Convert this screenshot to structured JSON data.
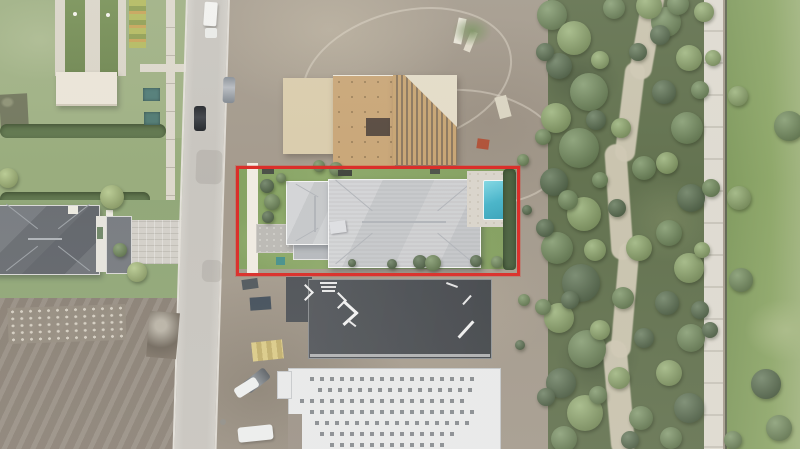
{
  "scene": {
    "description": "Aerial drone photograph of a residential street with a new-construction subject property outlined in red; existing home and lawns to the west, two homes under construction, and a wooded preserve with a sandy trail and concrete path to the east",
    "type": "aerial-photograph"
  },
  "annotation": {
    "label": "Subject property boundary",
    "box_style": "left:236px;top:166px;width:278px;height:104px;border-color:#e5231d",
    "color": "#e5231d"
  },
  "palette": {
    "red": "#e5231d",
    "lawn1": "#9cb07e",
    "lawn2": "#8da671",
    "court": "#6f8a4d",
    "walk": "#dcd7ca",
    "canopy": "#eae4d6",
    "hedge": "#5b7446",
    "road": "#c8c5be",
    "dirt": "#a39889",
    "ply": "#c9a26d",
    "roof": "#cccdd0",
    "pool": "#43c0d5",
    "deck": "#d9d4c9",
    "dkroof": "#45494e",
    "wroof": "#e9eaeb",
    "trail": "#cfc7b0",
    "path": "#d9d5ca",
    "rgrass": "#83a05c",
    "t1": "#4d6640",
    "t2": "#69884e",
    "t3": "#87a65e",
    "t4": "#a3bd6e"
  },
  "trees": [
    {
      "x": 552,
      "y": 15,
      "r": 15,
      "c": "t2"
    },
    {
      "x": 574,
      "y": 38,
      "r": 17,
      "c": "t3"
    },
    {
      "x": 559,
      "y": 66,
      "r": 13,
      "c": "t1"
    },
    {
      "x": 589,
      "y": 92,
      "r": 19,
      "c": "t2"
    },
    {
      "x": 556,
      "y": 118,
      "r": 15,
      "c": "t3"
    },
    {
      "x": 579,
      "y": 148,
      "r": 20,
      "c": "t2"
    },
    {
      "x": 554,
      "y": 182,
      "r": 14,
      "c": "t1"
    },
    {
      "x": 584,
      "y": 214,
      "r": 17,
      "c": "t3"
    },
    {
      "x": 557,
      "y": 248,
      "r": 16,
      "c": "t2"
    },
    {
      "x": 581,
      "y": 283,
      "r": 19,
      "c": "t1"
    },
    {
      "x": 559,
      "y": 318,
      "r": 15,
      "c": "t3"
    },
    {
      "x": 587,
      "y": 349,
      "r": 19,
      "c": "t2"
    },
    {
      "x": 561,
      "y": 383,
      "r": 15,
      "c": "t1"
    },
    {
      "x": 585,
      "y": 413,
      "r": 18,
      "c": "t3"
    },
    {
      "x": 564,
      "y": 439,
      "r": 13,
      "c": "t2"
    },
    {
      "x": 545,
      "y": 52,
      "r": 9,
      "c": "t1"
    },
    {
      "x": 543,
      "y": 137,
      "r": 8,
      "c": "t2"
    },
    {
      "x": 545,
      "y": 228,
      "r": 9,
      "c": "t1"
    },
    {
      "x": 543,
      "y": 307,
      "r": 8,
      "c": "t2"
    },
    {
      "x": 546,
      "y": 397,
      "r": 9,
      "c": "t1"
    },
    {
      "x": 568,
      "y": 200,
      "r": 10,
      "c": "t2"
    },
    {
      "x": 595,
      "y": 250,
      "r": 11,
      "c": "t3"
    },
    {
      "x": 570,
      "y": 300,
      "r": 9,
      "c": "t1"
    },
    {
      "x": 596,
      "y": 120,
      "r": 10,
      "c": "t1"
    },
    {
      "x": 600,
      "y": 60,
      "r": 9,
      "c": "t3"
    },
    {
      "x": 600,
      "y": 330,
      "r": 10,
      "c": "t3"
    },
    {
      "x": 598,
      "y": 395,
      "r": 9,
      "c": "t2"
    },
    {
      "x": 600,
      "y": 180,
      "r": 8,
      "c": "t2"
    },
    {
      "x": 614,
      "y": 8,
      "r": 11,
      "c": "t2"
    },
    {
      "x": 638,
      "y": 52,
      "r": 9,
      "c": "t1"
    },
    {
      "x": 621,
      "y": 128,
      "r": 10,
      "c": "t3"
    },
    {
      "x": 644,
      "y": 168,
      "r": 12,
      "c": "t2"
    },
    {
      "x": 617,
      "y": 208,
      "r": 9,
      "c": "t1"
    },
    {
      "x": 639,
      "y": 248,
      "r": 13,
      "c": "t3"
    },
    {
      "x": 623,
      "y": 298,
      "r": 11,
      "c": "t2"
    },
    {
      "x": 644,
      "y": 338,
      "r": 10,
      "c": "t1"
    },
    {
      "x": 619,
      "y": 378,
      "r": 11,
      "c": "t3"
    },
    {
      "x": 641,
      "y": 418,
      "r": 12,
      "c": "t2"
    },
    {
      "x": 630,
      "y": 440,
      "r": 9,
      "c": "t1"
    },
    {
      "x": 666,
      "y": 22,
      "r": 15,
      "c": "t2"
    },
    {
      "x": 689,
      "y": 58,
      "r": 13,
      "c": "t3"
    },
    {
      "x": 664,
      "y": 92,
      "r": 12,
      "c": "t1"
    },
    {
      "x": 687,
      "y": 128,
      "r": 16,
      "c": "t2"
    },
    {
      "x": 667,
      "y": 163,
      "r": 11,
      "c": "t3"
    },
    {
      "x": 691,
      "y": 198,
      "r": 14,
      "c": "t1"
    },
    {
      "x": 669,
      "y": 233,
      "r": 13,
      "c": "t2"
    },
    {
      "x": 689,
      "y": 268,
      "r": 15,
      "c": "t3"
    },
    {
      "x": 667,
      "y": 303,
      "r": 12,
      "c": "t1"
    },
    {
      "x": 691,
      "y": 338,
      "r": 14,
      "c": "t2"
    },
    {
      "x": 669,
      "y": 373,
      "r": 13,
      "c": "t3"
    },
    {
      "x": 689,
      "y": 408,
      "r": 15,
      "c": "t1"
    },
    {
      "x": 671,
      "y": 438,
      "r": 11,
      "c": "t2"
    },
    {
      "x": 700,
      "y": 90,
      "r": 9,
      "c": "t2"
    },
    {
      "x": 702,
      "y": 250,
      "r": 8,
      "c": "t3"
    },
    {
      "x": 700,
      "y": 310,
      "r": 9,
      "c": "t1"
    },
    {
      "x": 649,
      "y": 6,
      "r": 13,
      "c": "t3"
    },
    {
      "x": 678,
      "y": 4,
      "r": 11,
      "c": "t2"
    },
    {
      "x": 704,
      "y": 12,
      "r": 10,
      "c": "t3"
    },
    {
      "x": 660,
      "y": 35,
      "r": 10,
      "c": "t1"
    },
    {
      "x": 713,
      "y": 58,
      "r": 8,
      "c": "t3"
    },
    {
      "x": 711,
      "y": 188,
      "r": 9,
      "c": "t2"
    },
    {
      "x": 710,
      "y": 330,
      "r": 8,
      "c": "t1"
    },
    {
      "x": 789,
      "y": 126,
      "r": 15,
      "c": "t2"
    },
    {
      "x": 738,
      "y": 96,
      "r": 10,
      "c": "t3"
    },
    {
      "x": 739,
      "y": 198,
      "r": 12,
      "c": "t3"
    },
    {
      "x": 741,
      "y": 280,
      "r": 12,
      "c": "t2"
    },
    {
      "x": 766,
      "y": 384,
      "r": 15,
      "c": "t1"
    },
    {
      "x": 779,
      "y": 428,
      "r": 13,
      "c": "t2"
    },
    {
      "x": 733,
      "y": 440,
      "r": 9,
      "c": "t2"
    },
    {
      "x": 112,
      "y": 197,
      "r": 12,
      "c": "t4"
    },
    {
      "x": 8,
      "y": 178,
      "r": 10,
      "c": "t4"
    },
    {
      "x": 137,
      "y": 272,
      "r": 10,
      "c": "t4"
    },
    {
      "x": 120,
      "y": 250,
      "r": 7,
      "c": "t2"
    },
    {
      "x": 336,
      "y": 169,
      "r": 7,
      "c": "t2"
    },
    {
      "x": 319,
      "y": 166,
      "r": 6,
      "c": "t2"
    },
    {
      "x": 267,
      "y": 186,
      "r": 7,
      "c": "t1"
    },
    {
      "x": 272,
      "y": 202,
      "r": 8,
      "c": "t2"
    },
    {
      "x": 268,
      "y": 217,
      "r": 6,
      "c": "t1"
    },
    {
      "x": 281,
      "y": 178,
      "r": 5,
      "c": "t2"
    },
    {
      "x": 420,
      "y": 262,
      "r": 7,
      "c": "t1"
    },
    {
      "x": 433,
      "y": 263,
      "r": 8,
      "c": "t2"
    },
    {
      "x": 476,
      "y": 261,
      "r": 6,
      "c": "t1"
    },
    {
      "x": 497,
      "y": 262,
      "r": 6,
      "c": "t2"
    },
    {
      "x": 392,
      "y": 264,
      "r": 5,
      "c": "t1"
    },
    {
      "x": 352,
      "y": 263,
      "r": 4,
      "c": "t1"
    },
    {
      "x": 527,
      "y": 210,
      "r": 5,
      "c": "t1"
    },
    {
      "x": 524,
      "y": 300,
      "r": 6,
      "c": "t2"
    },
    {
      "x": 520,
      "y": 345,
      "r": 5,
      "c": "t1"
    },
    {
      "x": 523,
      "y": 160,
      "r": 6,
      "c": "t2"
    }
  ],
  "objects": [
    {
      "name": "box-truck-white",
      "style": "left:204px;top:2px;width:13px;height:24px;background:#f1f1ef;border-radius:2px;transform:rotate(4deg);box-shadow:1px 2px 2px rgba(0,0,0,.25)"
    },
    {
      "name": "car-white",
      "style": "left:205px;top:28px;width:12px;height:10px;background:#e9eae7;border-radius:2px"
    },
    {
      "name": "car-silver",
      "style": "left:223px;top:77px;width:12px;height:26px;background:linear-gradient(180deg,#868d96,#b6bac0 40%,#7d848d);border-radius:3px;transform:rotate(2deg)"
    },
    {
      "name": "car-black",
      "style": "left:194px;top:106px;width:12px;height:25px;background:linear-gradient(180deg,#202327,#3a3e44 45%,#1d2024);border-radius:3px"
    },
    {
      "name": "manhole-cover",
      "style": "left:220px;top:419px;width:6px;height:6px;background:#8e8b83;border-radius:50%"
    },
    {
      "name": "dumpster",
      "style": "left:250px;top:297px;width:21px;height:13px;background:#3e4b58;transform:rotate(-4deg)"
    },
    {
      "name": "equipment-bin",
      "style": "left:242px;top:279px;width:16px;height:10px;background:#4c5459;transform:rotate(-8deg)"
    },
    {
      "name": "lumber-stack-yellow",
      "style": "left:252px;top:341px;width:31px;height:19px;background:repeating-linear-gradient(90deg,#dcca80 0 5px,#c3ae64 5px 10px);transform:rotate(-6deg)"
    },
    {
      "name": "suv-gray",
      "style": "left:243px;top:374px;width:27px;height:13px;background:linear-gradient(90deg,#5d6267,#898f94 50%,#565b60);border-radius:3px;transform:rotate(-38deg)"
    },
    {
      "name": "car-white-2",
      "style": "left:234px;top:382px;width:25px;height:11px;background:#eef0ef;border-radius:3px;transform:rotate(-32deg)"
    },
    {
      "name": "van-white",
      "style": "left:238px;top:426px;width:35px;height:15px;background:#edefee;border-radius:3px;transform:rotate(-6deg);box-shadow:1px 2px 2px rgba(0,0,0,.2)"
    },
    {
      "name": "machine-orange",
      "style": "left:477px;top:139px;width:12px;height:10px;background:#b54a2d;transform:rotate(8deg)"
    },
    {
      "name": "utility-box-1",
      "style": "left:143px;top:88px;width:17px;height:13px;background:#4a7a74;box-shadow:inset 0 0 3px rgba(0,0,0,.4)"
    },
    {
      "name": "utility-box-2",
      "style": "left:144px;top:112px;width:16px;height:13px;background:#49786f;box-shadow:inset 0 0 3px rgba(0,0,0,.4)"
    },
    {
      "name": "lumber-white-1",
      "style": "left:456px;top:18px;width:8px;height:26px;background:#e7e3d5;transform:rotate(12deg)"
    },
    {
      "name": "lumber-white-2",
      "style": "left:467px;top:31px;width:7px;height:21px;background:#ded8c6;transform:rotate(22deg)"
    },
    {
      "name": "lumber-pile-east",
      "style": "left:497px;top:96px;width:12px;height:22px;background:#dad3be;transform:rotate(-15deg)"
    },
    {
      "name": "grass-patch",
      "style": "left:452px;top:16px;width:40px;height:30px;background:radial-gradient(closest-side,#79905c,rgba(121,144,92,0))"
    },
    {
      "name": "debris-pile",
      "style": "left:148px;top:312px;width:30px;height:46px;background:radial-gradient(circle at 40% 30%,#b9b2a4 15%,#6f6558 60%,#837769);transform:rotate(5deg)"
    },
    {
      "name": "storage-bin-teal",
      "style": "left:276px;top:257px;width:9px;height:8px;background:#3e8f8a"
    },
    {
      "name": "ground-marking-1",
      "style": "left:262px;top:168px;width:12px;height:6px;background:#454a40"
    },
    {
      "name": "ground-marking-2",
      "style": "left:338px;top:170px;width:14px;height:6px;background:#3c4038"
    },
    {
      "name": "ground-marking-3",
      "style": "left:430px;top:169px;width:10px;height:5px;background:#4a4f45"
    },
    {
      "name": "flag-marker-1",
      "style": "left:73px;top:12px;width:4px;height:4px;background:#f4f2ea;border-radius:50%"
    },
    {
      "name": "flag-marker-2",
      "style": "left:106px;top:13px;width:4px;height:4px;background:#f4f2ea;border-radius:50%"
    },
    {
      "name": "ridge-cap-marking",
      "style": "left:320px;top:282px;width:17px;height:2px;background:#e8e8e8"
    },
    {
      "name": "ridge-cap-marking",
      "style": "left:321px;top:286px;width:15px;height:2px;background:#e2e2e2"
    },
    {
      "name": "ridge-cap-marking",
      "style": "left:322px;top:290px;width:13px;height:2px;background:#e8e8e8"
    },
    {
      "name": "ridge-cap-marking",
      "style": "left:303px;top:288px;width:12px;height:2px;background:#eeeeee;transform:rotate(45deg)"
    },
    {
      "name": "ridge-cap-marking",
      "style": "left:303px;top:295px;width:12px;height:2px;background:#eeeeee;transform:rotate(-45deg)"
    },
    {
      "name": "ridge-cap-marking",
      "style": "left:336px;top:296px;width:12px;height:2px;background:#eeeeee;transform:rotate(45deg)"
    },
    {
      "name": "ridge-cap-marking",
      "style": "left:336px;top:303px;width:12px;height:2px;background:#eeeeee;transform:rotate(-45deg)"
    },
    {
      "name": "ridge-cap-marking",
      "style": "left:341px;top:306px;width:19px;height:3px;background:#f2f2f2;transform:rotate(42deg)"
    },
    {
      "name": "ridge-cap-marking",
      "style": "left:341px;top:317px;width:19px;height:3px;background:#f2f2f2;transform:rotate(-42deg)"
    },
    {
      "name": "ridge-cap-marking",
      "style": "left:346px;top:322px;width:11px;height:2px;background:#e8e8e8;transform:rotate(38deg)"
    },
    {
      "name": "ridge-cap-marking",
      "style": "left:455px;top:328px;width:22px;height:3px;background:#efefef;transform:rotate(-48deg)"
    },
    {
      "name": "ridge-cap-marking",
      "style": "left:461px;top:299px;width:12px;height:2px;background:#e8e8e8;transform:rotate(-48deg)"
    },
    {
      "name": "ridge-cap-marking",
      "style": "left:446px;top:284px;width:12px;height:2px;background:#e4e4e4;transform:rotate(20deg)"
    }
  ]
}
